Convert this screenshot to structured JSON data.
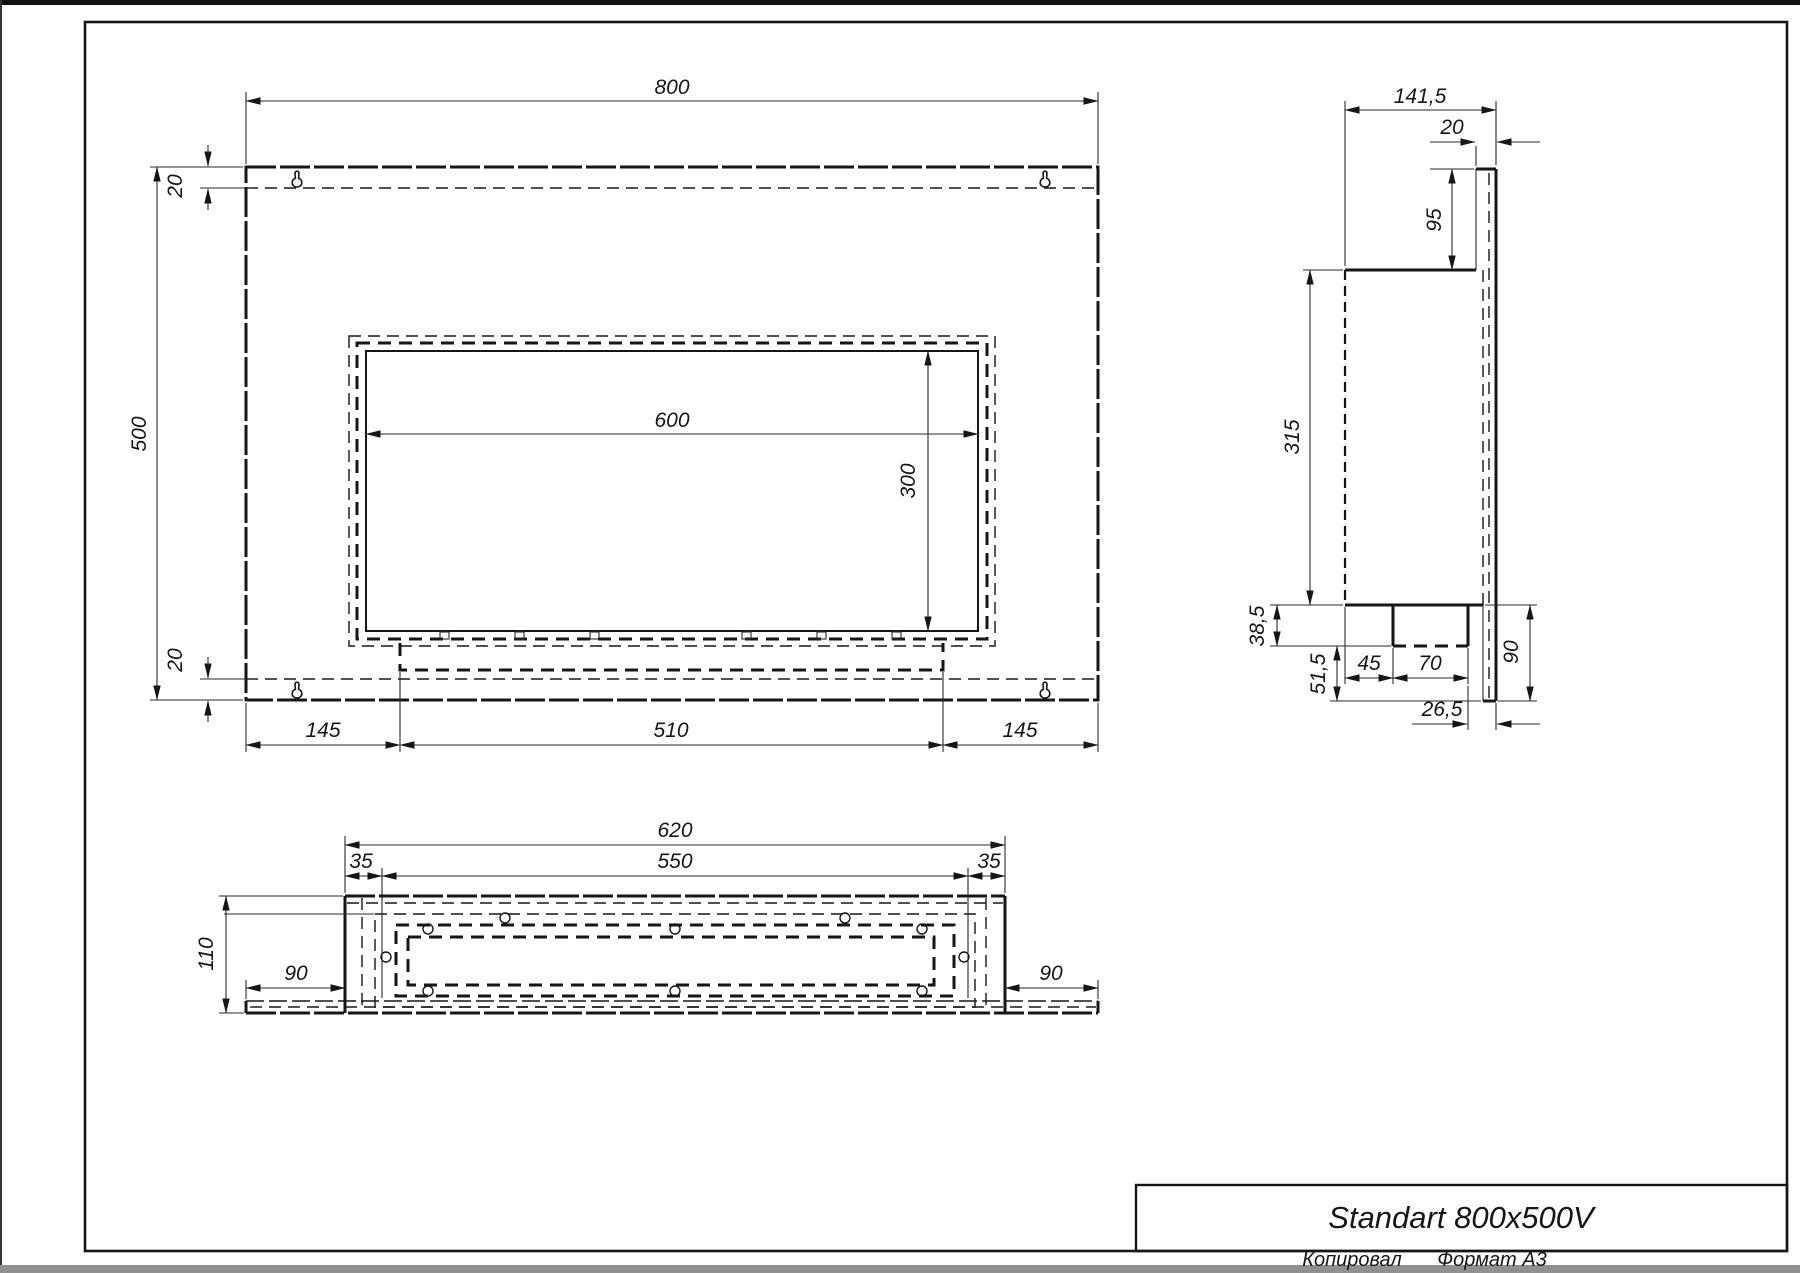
{
  "page": {
    "background": "#ffffff",
    "line_color": "#161616",
    "title_block": {
      "title": "Standart 800x500V"
    },
    "footer": {
      "copied_by": "Копировал",
      "format": "Формат А3"
    }
  },
  "views": {
    "front": {
      "dims": {
        "overall_width": "800",
        "overall_height": "500",
        "top_fold": "20",
        "bottom_fold": "20",
        "opening_width": "600",
        "opening_height": "300",
        "bottom_left_margin": "145",
        "tray_width": "510",
        "bottom_right_margin": "145"
      }
    },
    "side": {
      "dims": {
        "overall_depth": "141,5",
        "flange_depth": "20",
        "top_offset": "95",
        "body_height": "315",
        "tray_drop": "38,5",
        "below_tray": "51,5",
        "tray_offset": "45",
        "tray_depth": "70",
        "back_offset": "26,5",
        "flange_drop": "90"
      }
    },
    "bottom": {
      "dims": {
        "overall_width": "620",
        "frame_width": "550",
        "left_margin": "35",
        "right_margin": "35",
        "overall_depth": "110",
        "flange_left": "90",
        "flange_right": "90"
      }
    }
  }
}
